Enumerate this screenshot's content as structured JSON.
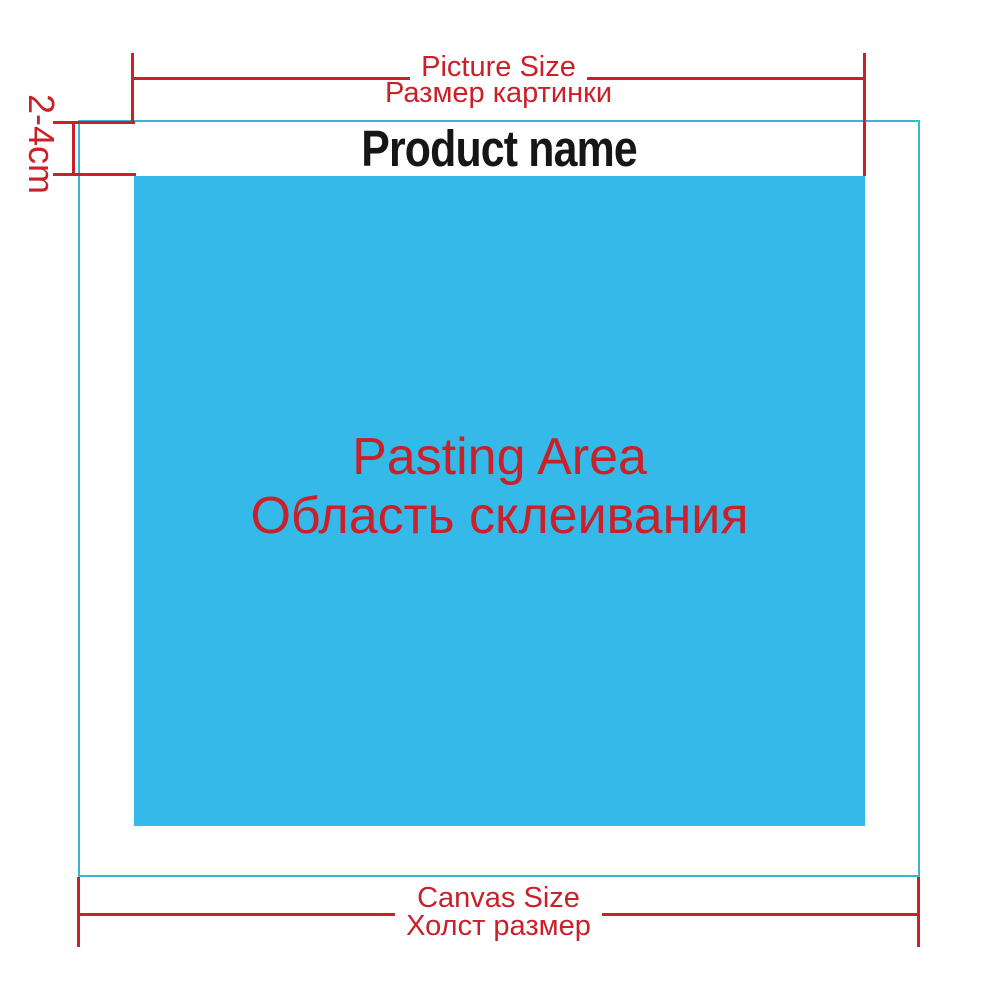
{
  "colors": {
    "dimension_red": "#c9202a",
    "canvas_outline_cyan": "#38b7d2",
    "pasting_area_blue": "#34b9e9",
    "product_name_black": "#161616"
  },
  "diagram": {
    "product_name": "Product name",
    "top_dimension": {
      "line1": "Picture Size",
      "line2": "Размер картинки"
    },
    "bottom_dimension": {
      "line1": "Canvas Size",
      "line2": "Холст размер"
    },
    "pasting_area": {
      "line1": "Pasting Area",
      "line2": "Область склеивания"
    },
    "left_margin": "2-4cm"
  }
}
